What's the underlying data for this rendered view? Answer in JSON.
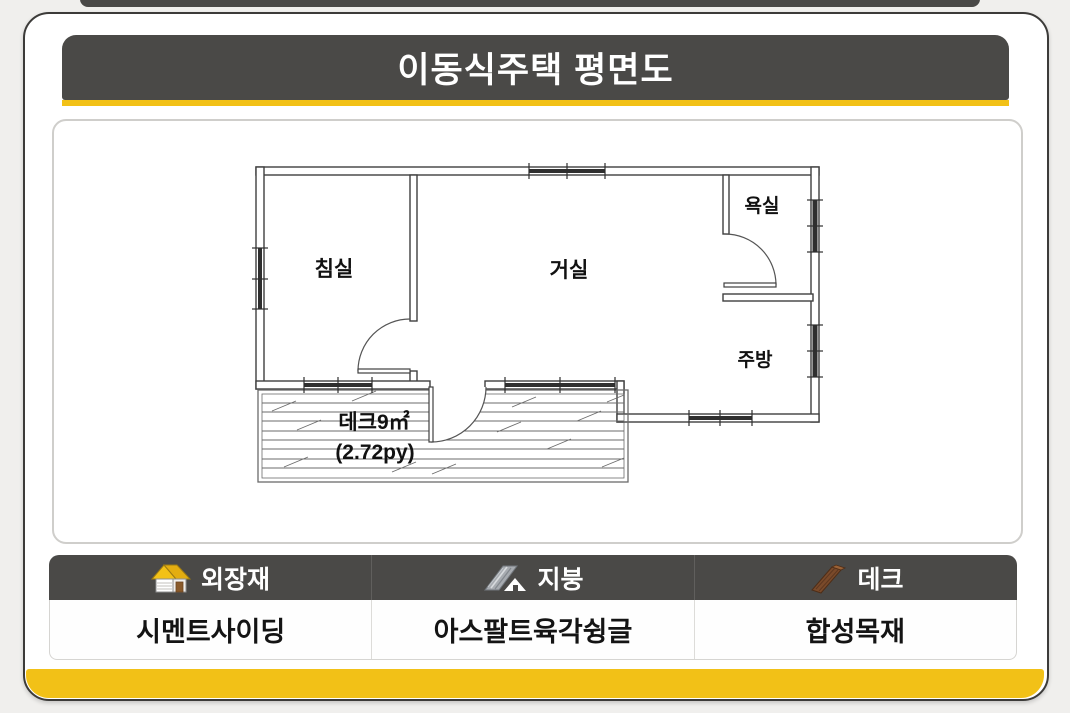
{
  "title": "이동식주택 평면도",
  "floor_plan": {
    "rooms": {
      "bedroom": "침실",
      "living": "거실",
      "bathroom": "욕실",
      "kitchen": "주방"
    },
    "deck": {
      "area_label": "데크9㎡",
      "pyeong_label": "(2.72py)"
    }
  },
  "legend": {
    "columns": [
      {
        "icon": "house-icon",
        "header": "외장재",
        "value": "시멘트사이딩"
      },
      {
        "icon": "roof-icon",
        "header": "지붕",
        "value": "아스팔트육각슁글"
      },
      {
        "icon": "deck-icon",
        "header": "데크",
        "value": "합성목재"
      }
    ]
  },
  "colors": {
    "accent_yellow": "#F2C117",
    "bar_gray": "#4A4947",
    "wall_line": "#3F3F3F"
  }
}
